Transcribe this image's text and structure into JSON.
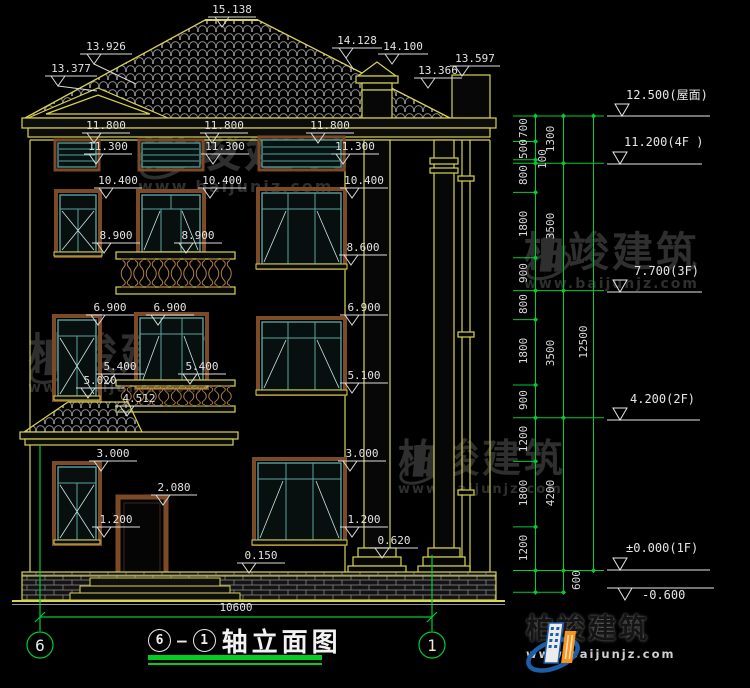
{
  "marks": {
    "peak": "15.138",
    "slope_l": "13.926",
    "gable_l": "13.377",
    "slope_r": "14.128",
    "chimney": "14.100",
    "roof_r": "13.366",
    "parapet": "13.597",
    "eave": "11.800",
    "vent": "11.300",
    "f4_head": "10.400",
    "f4_sill": "8.900",
    "f4_sill_big": "8.600",
    "f3_head": "6.900",
    "f3_sill": "5.400",
    "f3_sill_big": "5.100",
    "canopy_top": "5.020",
    "canopy_eave": "4.512",
    "f1_head": "3.000",
    "door_head": "2.080",
    "f1_sill": "1.200",
    "porch": "0.150",
    "col_base": "0.620",
    "width": "10600"
  },
  "chain": {
    "c1": [
      "700",
      "500",
      "100",
      "800",
      "1800",
      "900",
      "800",
      "1800",
      "900",
      "1200",
      "1800",
      "1200"
    ],
    "c2": [
      "1300",
      "3500",
      "3500",
      "4200"
    ],
    "c600": "600",
    "total": "12500"
  },
  "levels": {
    "roof": "12.500(屋面)",
    "f4": "11.200(4F )",
    "f3": "7.700(3F)",
    "f2": "4.200(2F)",
    "f1": "±0.000(1F)",
    "below": "-0.600"
  },
  "grid": {
    "left": "6",
    "right": "1"
  },
  "title": {
    "ax1": "6",
    "dash": "—",
    "ax2": "1",
    "name": "轴立面图"
  },
  "brand": {
    "name": "柏竣建筑",
    "url": "www.baijunjz.com"
  },
  "colors": {
    "line_yellow": "#d9d44e",
    "line_green": "#00cc33",
    "text_white": "#e0e0e0",
    "window_teal": "#5aa39e",
    "wood_brown": "#7c4a26",
    "logo_blue": "#1c5fa8",
    "logo_orange": "#f7941d"
  }
}
